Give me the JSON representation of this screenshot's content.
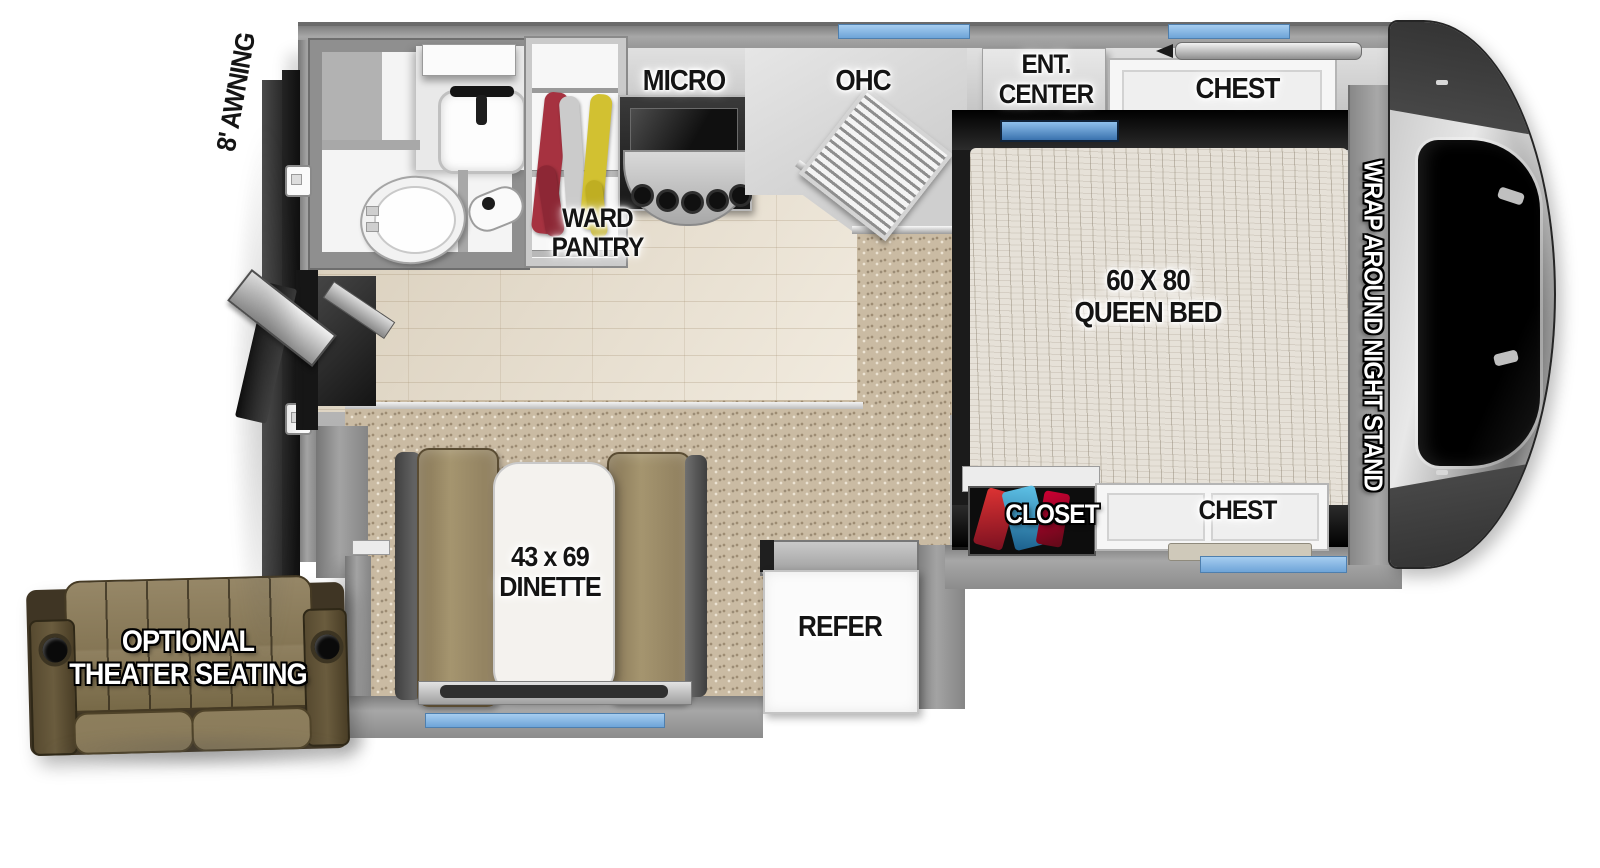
{
  "labels": {
    "awning": "8' AWNING",
    "ward_1": "WARD",
    "ward_2": "PANTRY",
    "micro": "MICRO",
    "ohc": "OHC",
    "ent_1": "ENT.",
    "ent_2": "CENTER",
    "chest_top": "CHEST",
    "bed_1": "60 X 80",
    "bed_2": "QUEEN BED",
    "night_stand": "WRAP AROUND NIGHT STAND",
    "closet": "CLOSET",
    "chest_bottom": "CHEST",
    "dinette_1": "43 x 69",
    "dinette_2": "DINETTE",
    "refer": "REFER",
    "theater_1": "OPTIONAL",
    "theater_2": "THEATER SEATING"
  },
  "colors": {
    "window_accent": "#7fb2e5",
    "wall_gray": "#8f8f8f",
    "carpet_tan": "#cabba3",
    "wood_floor": "#ece3d2",
    "bed_frame_black": "#1b1b1b",
    "dinette_cushion_brown": "#9d8d6d",
    "theater_sofa_brown": "#8c7d5f",
    "label_black": "#141414",
    "label_white": "#ffffff",
    "pantry_clothes": [
      "#a63240",
      "#cbcbcb",
      "#d2c131"
    ]
  }
}
